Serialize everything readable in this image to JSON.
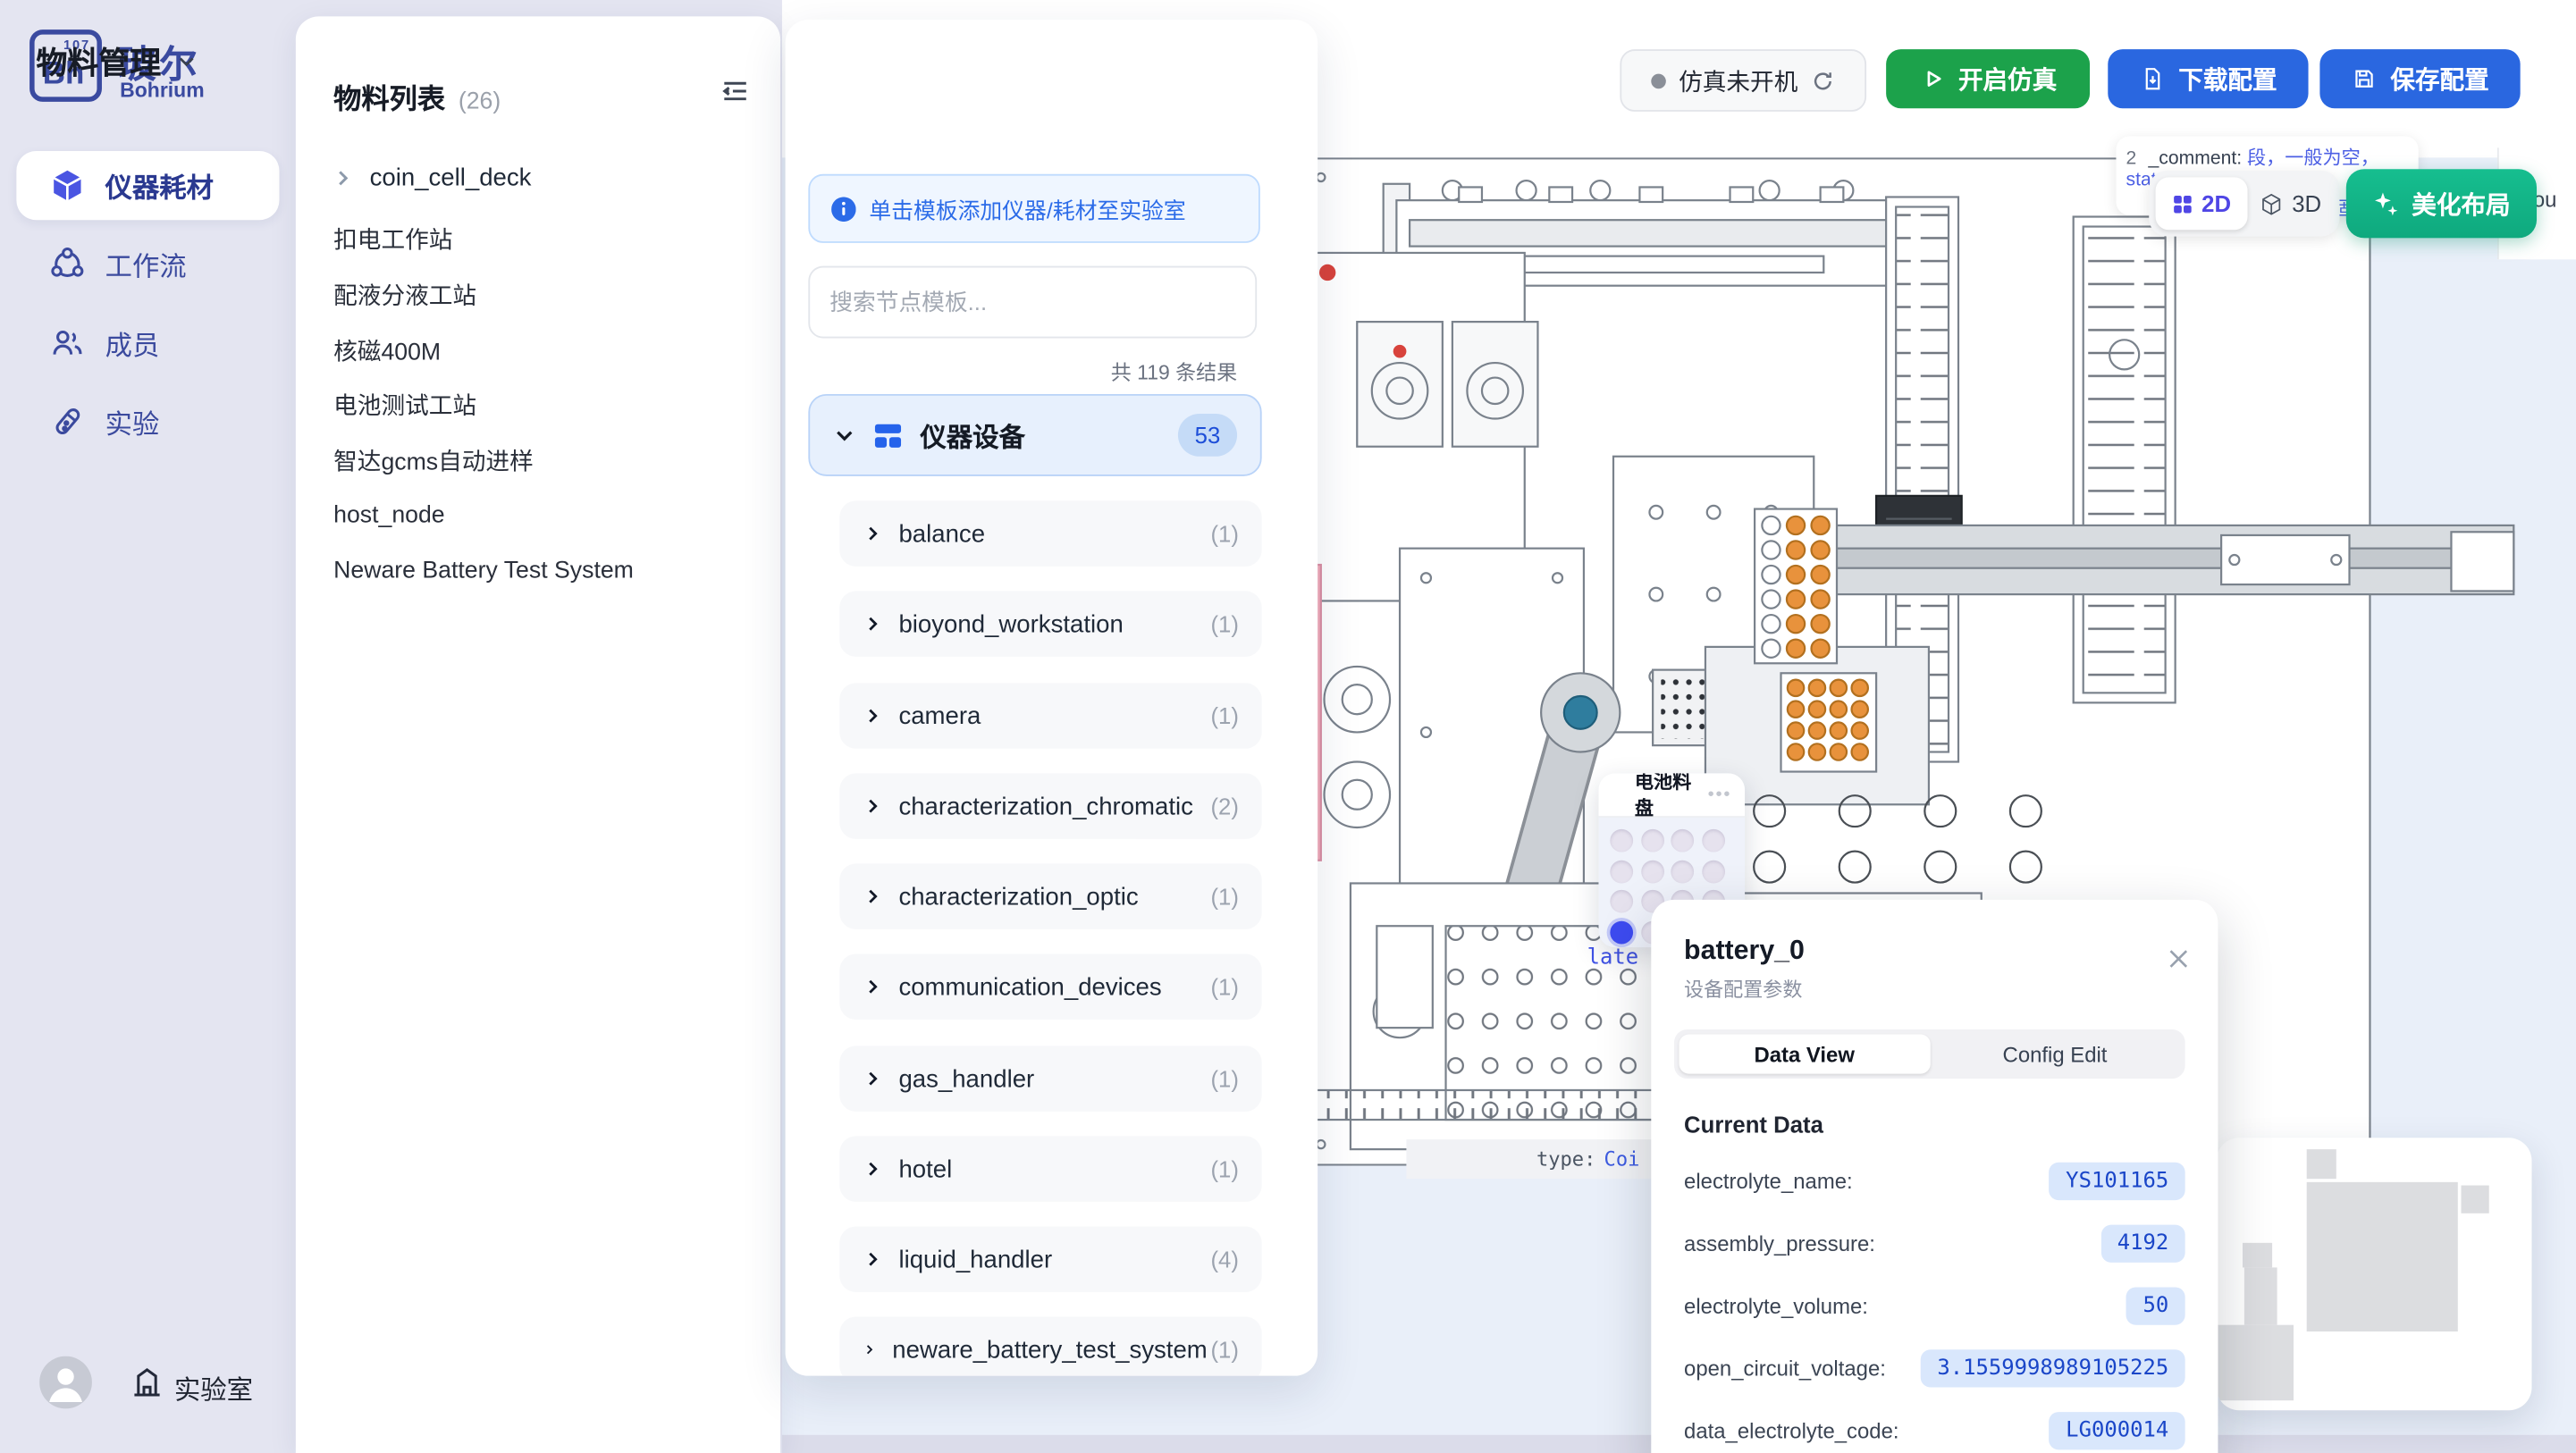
{
  "sidebar": {
    "logo": {
      "symbol": "Bh",
      "number": "107",
      "title": "玻尔",
      "subtitle": "Bohrium"
    },
    "items": [
      {
        "label": "仪器耗材"
      },
      {
        "label": "工作流"
      },
      {
        "label": "成员"
      },
      {
        "label": "实验"
      }
    ],
    "footer": {
      "label": "实验室"
    }
  },
  "materialList": {
    "title": "物料列表",
    "count": "(26)",
    "items": [
      "coin_cell_deck",
      "扣电工作站",
      "配液分液工站",
      "核磁400M",
      "电池测试工站",
      "智达gcms自动进样",
      "host_node",
      "Neware Battery Test System"
    ]
  },
  "header": {
    "title": "物料管理",
    "status": "仿真未开机",
    "start_button": "开启仿真",
    "download_button": "下载配置",
    "save_button": "保存配置"
  },
  "templates": {
    "banner": "单击模板添加仪器/耗材至实验室",
    "search_placeholder": "搜索节点模板...",
    "results": "共 119 条结果",
    "category": {
      "name": "仪器设备",
      "count": "53"
    },
    "items": [
      {
        "name": "balance",
        "count": "(1)"
      },
      {
        "name": "bioyond_workstation",
        "count": "(1)"
      },
      {
        "name": "camera",
        "count": "(1)"
      },
      {
        "name": "characterization_chromatic",
        "count": "(2)"
      },
      {
        "name": "characterization_optic",
        "count": "(1)"
      },
      {
        "name": "communication_devices",
        "count": "(1)"
      },
      {
        "name": "gas_handler",
        "count": "(1)"
      },
      {
        "name": "hotel",
        "count": "(1)"
      },
      {
        "name": "liquid_handler",
        "count": "(4)"
      },
      {
        "name": "neware_battery_test_system",
        "count": "(1)"
      }
    ]
  },
  "canvas": {
    "comment_prefix": "2",
    "comment_label": "_comment:",
    "comment_value": "段，一般为空，stat",
    "comment_line2": "法此固定",
    "right_clipped_text": "esou",
    "plate_clipped": "late",
    "type_label": "type:",
    "type_value": "Coi",
    "toggle": {
      "d2": "2D",
      "d3": "3D"
    },
    "beautify_button": "美化布局",
    "tray": {
      "title": "电池料盘",
      "menu": "•••"
    }
  },
  "popup": {
    "title": "battery_0",
    "subtitle": "设备配置参数",
    "tabs": {
      "active": "Data View",
      "inactive": "Config Edit"
    },
    "section": "Current Data",
    "fields": [
      {
        "label": "electrolyte_name:",
        "value": "YS101165"
      },
      {
        "label": "assembly_pressure:",
        "value": "4192"
      },
      {
        "label": "electrolyte_volume:",
        "value": "50"
      },
      {
        "label": "open_circuit_voltage:",
        "value": "3.1559998989105225"
      },
      {
        "label": "data_electrolyte_code:",
        "value": "LG000014"
      }
    ]
  },
  "colors": {
    "brand": "#3A4AA0",
    "accent_blue": "#2563EB",
    "green_button": "#1CA24B",
    "blue_button": "#2A67E0",
    "teal_button": "#12B286",
    "indigo_active": "#4F46E5",
    "canvas_bg": "#E9EFF9",
    "selected_dot": "#3D4BF0",
    "value_pill_bg": "#D9E7FC",
    "value_pill_text": "#1D4ED8"
  }
}
